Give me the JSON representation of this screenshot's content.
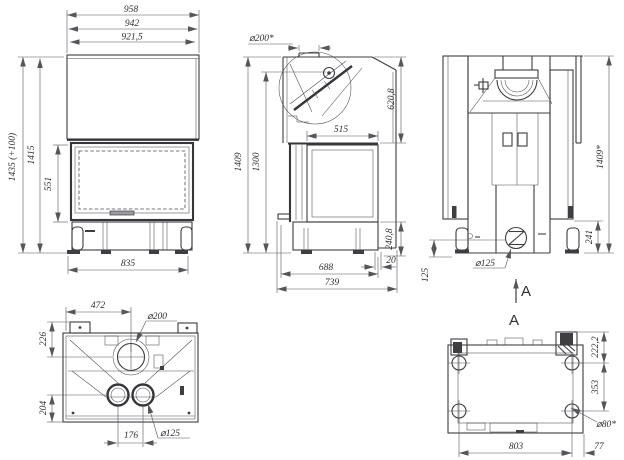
{
  "views": {
    "front": {
      "dims": {
        "width_total": "958",
        "width_mid": "942",
        "width_inner": "921,5",
        "height_total": "1435 (+100)",
        "height_body": "1415",
        "door_height": "551",
        "base_width": "835"
      }
    },
    "side": {
      "dims": {
        "flue_diameter": "⌀200*",
        "firebox_depth": "515",
        "hood_height": "620,8",
        "height_total": "1409",
        "height_firebox_top": "1300",
        "base_height": "240,8",
        "rear_offset": "20",
        "base_depth": "688",
        "depth_total": "739"
      }
    },
    "rear": {
      "dims": {
        "height_total": "1409*",
        "inlet_height": "241",
        "inlet_diameter": "⌀125",
        "inlet_offset": "125"
      },
      "section_arrow_label": "A",
      "view_label": "A"
    },
    "top": {
      "dims": {
        "flue_center_offset": "472",
        "flue_diameter": "⌀200",
        "rear_offset": "226",
        "front_offset": "204",
        "inlet_spacing": "176",
        "inlet_diameter": "⌀125"
      }
    },
    "bottom": {
      "dims": {
        "edge_to_hole": "222,2",
        "hole_spacing_depth": "353",
        "hole_diameter": "⌀80*",
        "hole_spacing_width": "803",
        "side_offset": "77"
      }
    }
  },
  "colors": {
    "line": "#3d3d42",
    "dim_line": "#55555a",
    "text": "#2e2e33",
    "background": "#ffffff"
  }
}
